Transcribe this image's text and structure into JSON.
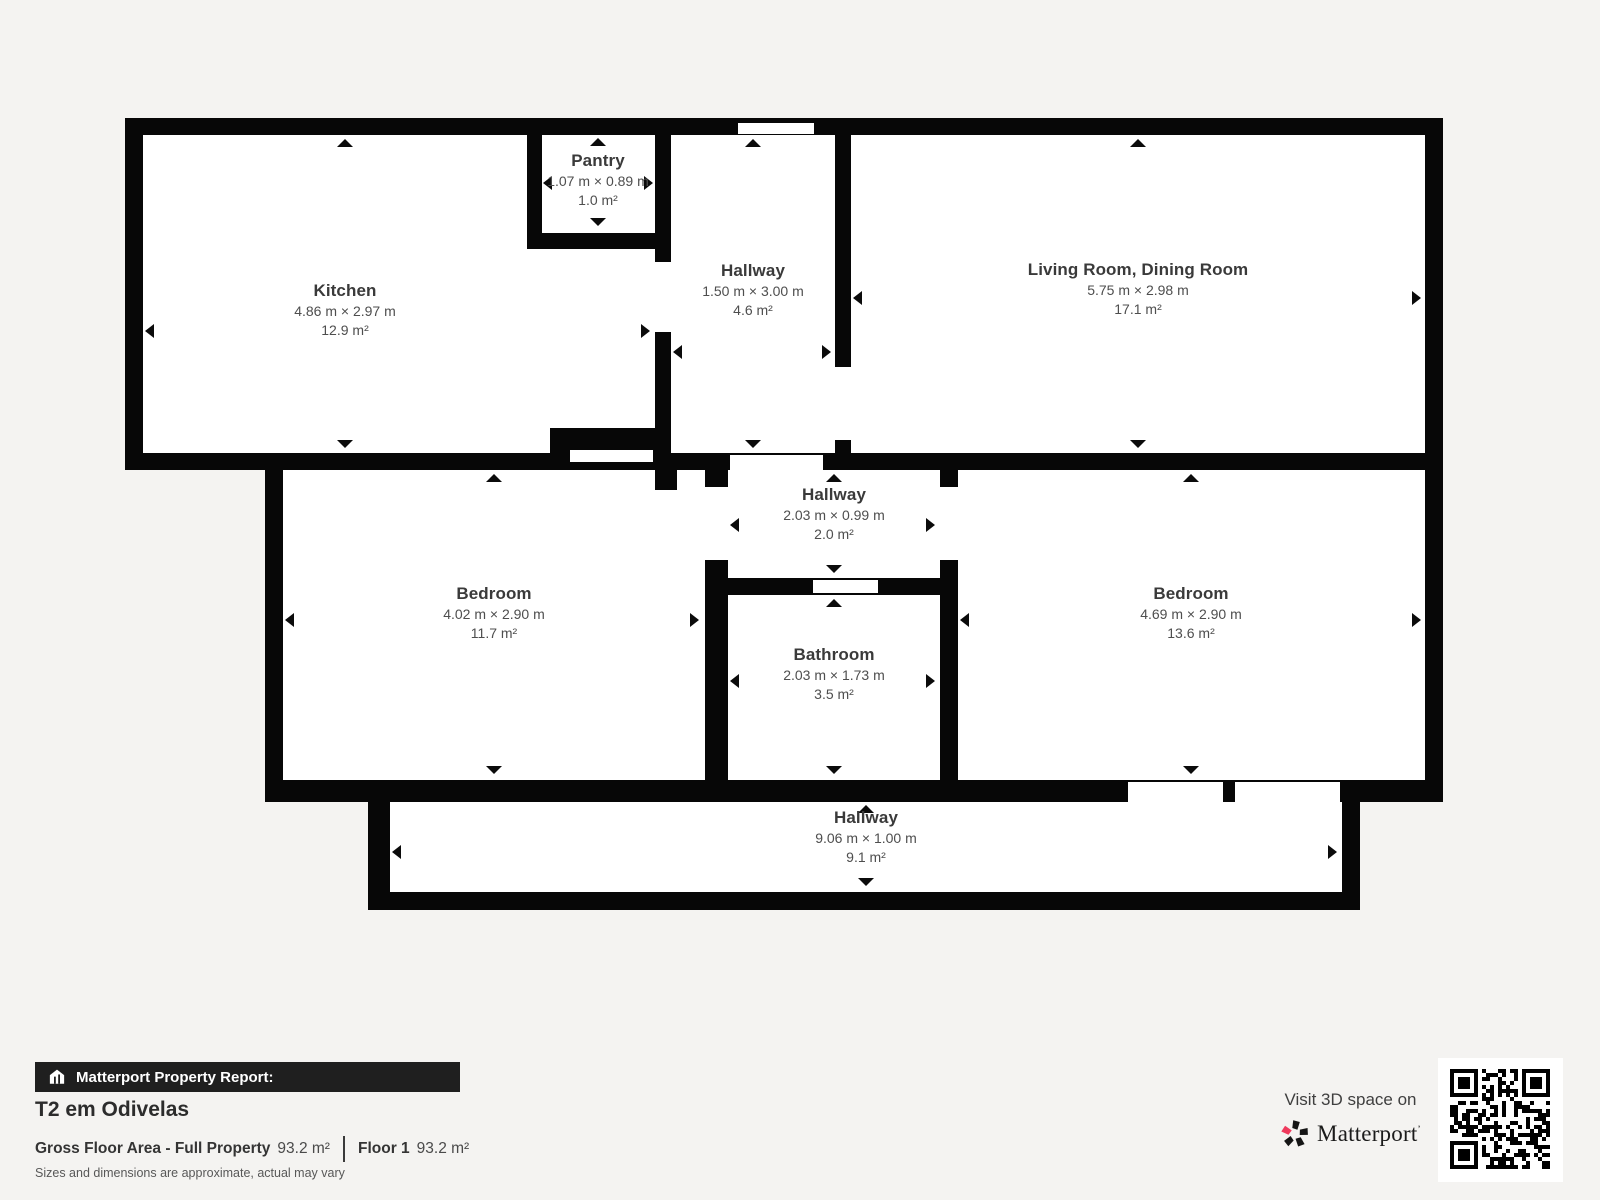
{
  "colors": {
    "page_bg": "#f4f3f1",
    "wall": "#070707",
    "room_bg": "#ffffff",
    "brand_red": "#ef3a5d"
  },
  "rooms": {
    "pantry": {
      "name": "Pantry",
      "dims": "1.07 m × 0.89 m",
      "area": "1.0 m²"
    },
    "kitchen": {
      "name": "Kitchen",
      "dims": "4.86 m × 2.97 m",
      "area": "12.9 m²"
    },
    "hallway_top": {
      "name": "Hallway",
      "dims": "1.50 m × 3.00 m",
      "area": "4.6 m²"
    },
    "living_dining": {
      "name": "Living Room, Dining Room",
      "dims": "5.75 m × 2.98 m",
      "area": "17.1 m²"
    },
    "bedroom_left": {
      "name": "Bedroom",
      "dims": "4.02 m × 2.90 m",
      "area": "11.7 m²"
    },
    "hallway_mid": {
      "name": "Hallway",
      "dims": "2.03 m × 0.99 m",
      "area": "2.0 m²"
    },
    "bathroom": {
      "name": "Bathroom",
      "dims": "2.03 m × 1.73 m",
      "area": "3.5 m²"
    },
    "bedroom_right": {
      "name": "Bedroom",
      "dims": "4.69 m × 2.90 m",
      "area": "13.6 m²"
    },
    "hallway_bottom": {
      "name": "Hallway",
      "dims": "9.06 m × 1.00 m",
      "area": "9.1 m²"
    }
  },
  "footer": {
    "report_label": "Matterport Property Report:",
    "property_title": "T2 em Odivelas",
    "gross_floor_area_label": "Gross Floor Area - Full Property",
    "gross_floor_area_value": "93.2 m²",
    "floor_label": "Floor 1",
    "floor_value": "93.2 m²",
    "disclaimer": "Sizes and dimensions are approximate, actual may vary"
  },
  "cta": {
    "visit_label": "Visit 3D space on",
    "brand_name": "Matterport",
    "trademark": "’"
  }
}
